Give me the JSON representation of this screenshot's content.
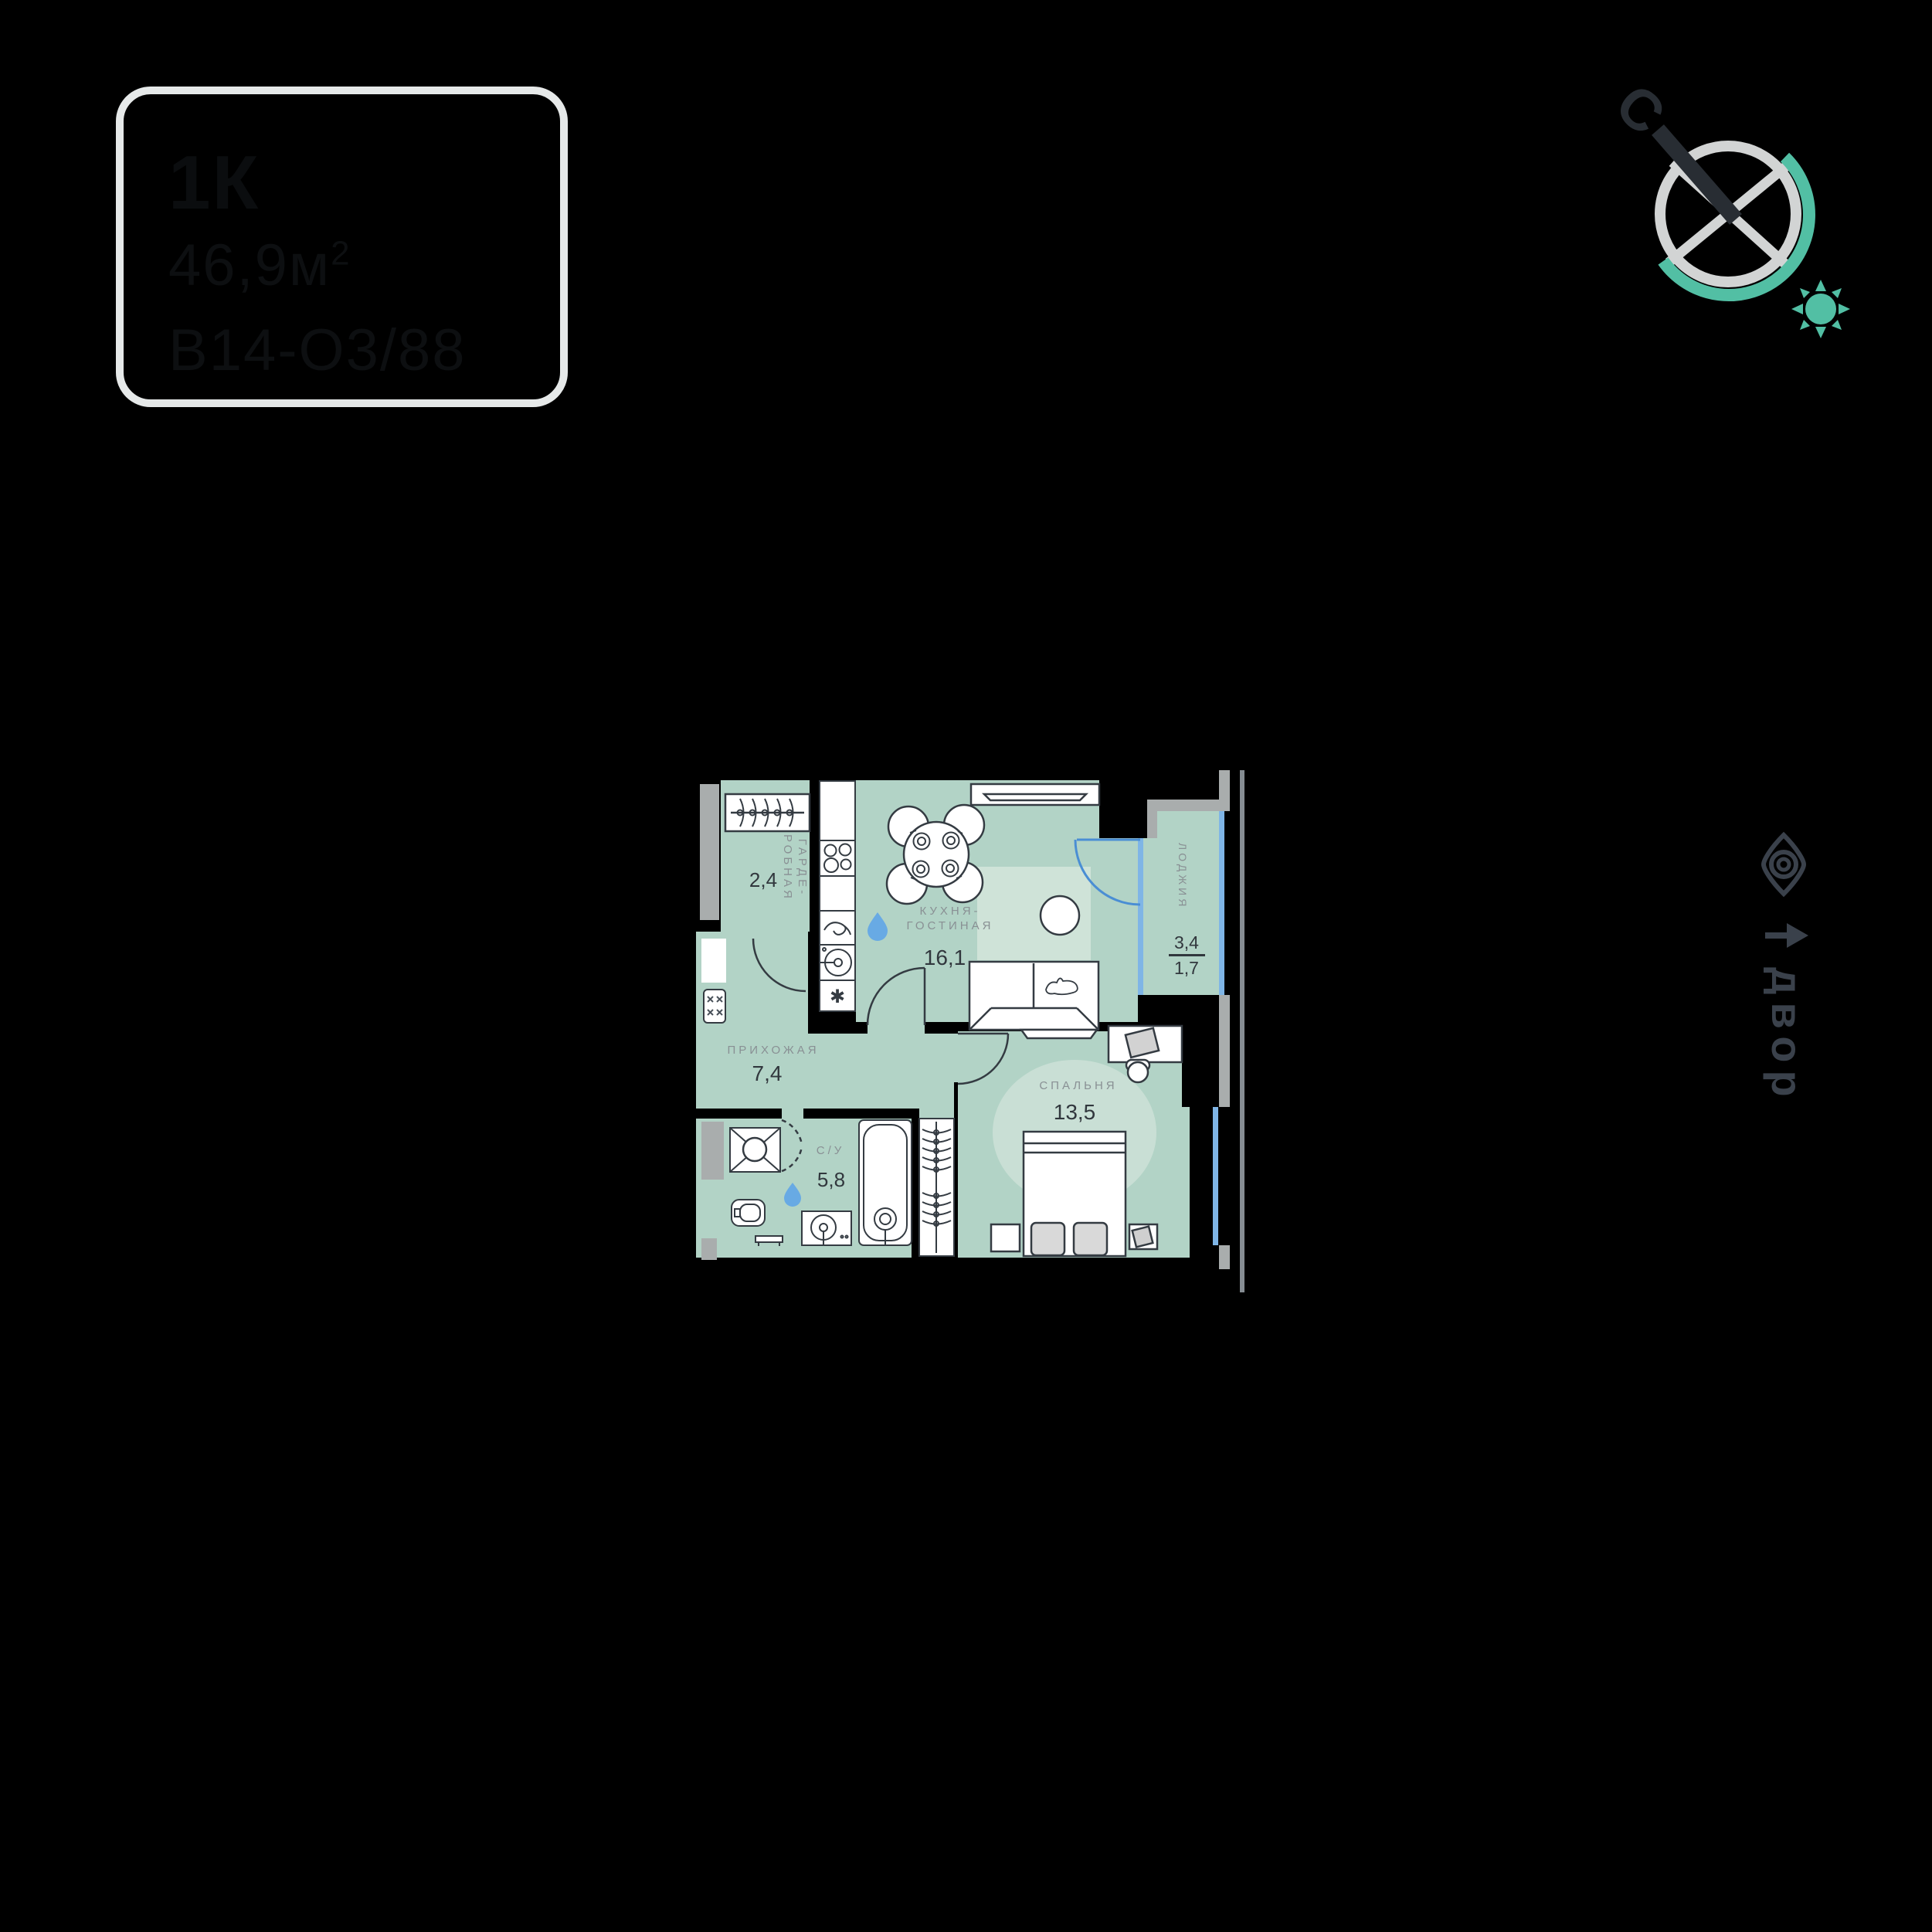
{
  "badge": {
    "rooms_label": "1К",
    "area_value": "46,9м",
    "area_sup": "2",
    "unit_code": "В14-О3/88"
  },
  "compass": {
    "north_label": "С"
  },
  "orientation": {
    "courtyard_label": "двор"
  },
  "plan": {
    "rooms": [
      {
        "id": "wardrobe",
        "name_line1": "ГАРДЕ-",
        "name_line2": "РОБНАЯ",
        "area": "2,4"
      },
      {
        "id": "kitchen_living",
        "name_line1": "КУХНЯ-",
        "name_line2": "ГОСТИНАЯ",
        "area": "16,1"
      },
      {
        "id": "hallway",
        "name": "ПРИХОЖАЯ",
        "area": "7,4"
      },
      {
        "id": "bathroom",
        "name": "С/У",
        "area": "5,8"
      },
      {
        "id": "bedroom",
        "name": "СПАЛЬНЯ",
        "area": "13,5"
      },
      {
        "id": "loggia",
        "name": "ЛОДЖИЯ",
        "area_full": "3,4",
        "area_reduced": "1,7"
      }
    ],
    "symbols": {
      "fridge": "✱"
    },
    "colors": {
      "floor": "#b2d3c6",
      "floor_light": "#cfe3d8",
      "glow": "#c9dfd5",
      "furniture_stroke": "#343b42",
      "glass": "#7fb5e6",
      "door_arc": "#4a8ed4",
      "drop": "#68aae4",
      "outer_gray": "#a9adad",
      "facade_gray": "#858c92",
      "label_gray": "#899094",
      "number_dark": "#31373d",
      "accent_teal": "#52bfa4",
      "needle_dark": "#282d33",
      "slate": "#3a414b",
      "badge_border": "#e6e9e9",
      "badge_text": "#0d0f11"
    }
  }
}
